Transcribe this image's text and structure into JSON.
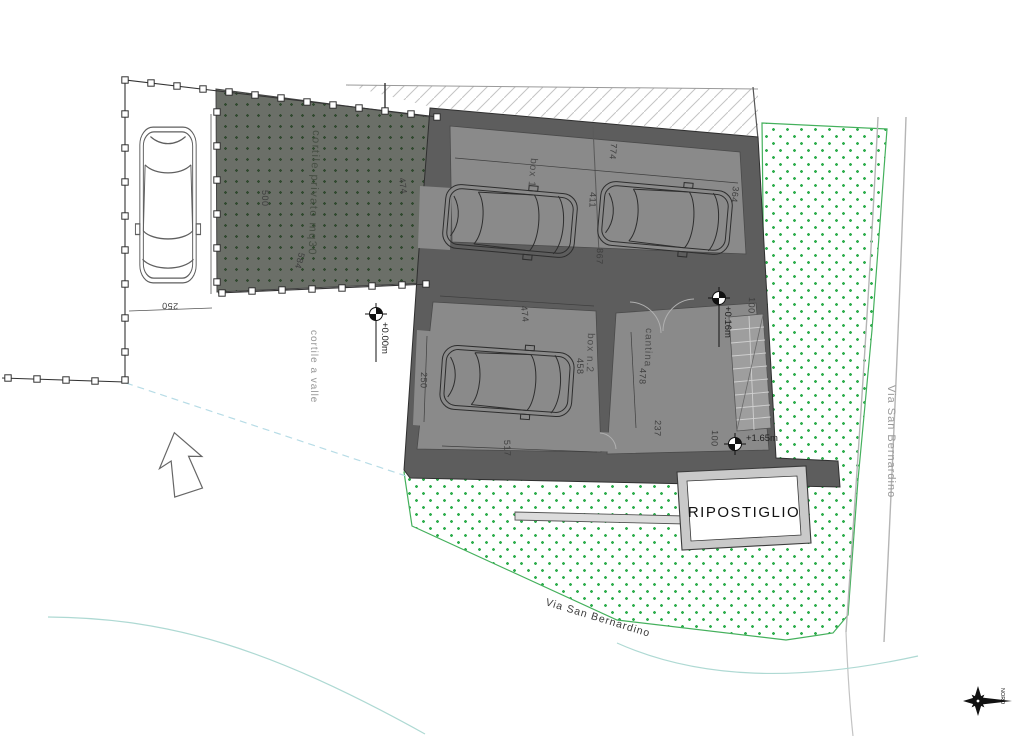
{
  "drawing": {
    "rooms": {
      "box1": "box 1",
      "box2": "box n.2",
      "cantina": "cantina",
      "ripostiglio": "RIPOSTIGLIO"
    },
    "areas": {
      "private_courtyard": "cortile privato mq30",
      "valley_courtyard": "cortile a valle"
    },
    "streets": {
      "right": "Via San Bernardino",
      "bottom": "Via San Bernardino"
    },
    "levels": {
      "courtyard": "+0.00m",
      "entry": "+0.16m",
      "upper_terrace": "+1.65m"
    },
    "compass": {
      "north": "NORD"
    },
    "dimensions": {
      "court_width": "250",
      "court_depth": "500",
      "court_diagonal": "584",
      "court_side": "474",
      "box1_width": "774",
      "box1_bay_left": "411",
      "box1_bay_right": "364",
      "box1_depth": "867",
      "box2_width": "474",
      "box2_depth": "458",
      "box2_front": "517",
      "box2_door": "250",
      "cantina_depth": "478",
      "cantina_width": "237",
      "landing_top": "100",
      "landing_bottom": "100"
    },
    "colors": {
      "wall": "#5d5d5d",
      "floor": "#8a8a8a",
      "court_fill": "#6b6f68",
      "court_dot": "#31492f",
      "garden_dot": "#2fae4e",
      "garden_edge": "#44b05c",
      "water_line": "#aed9d3",
      "dash_line": "#b7dce6"
    }
  }
}
